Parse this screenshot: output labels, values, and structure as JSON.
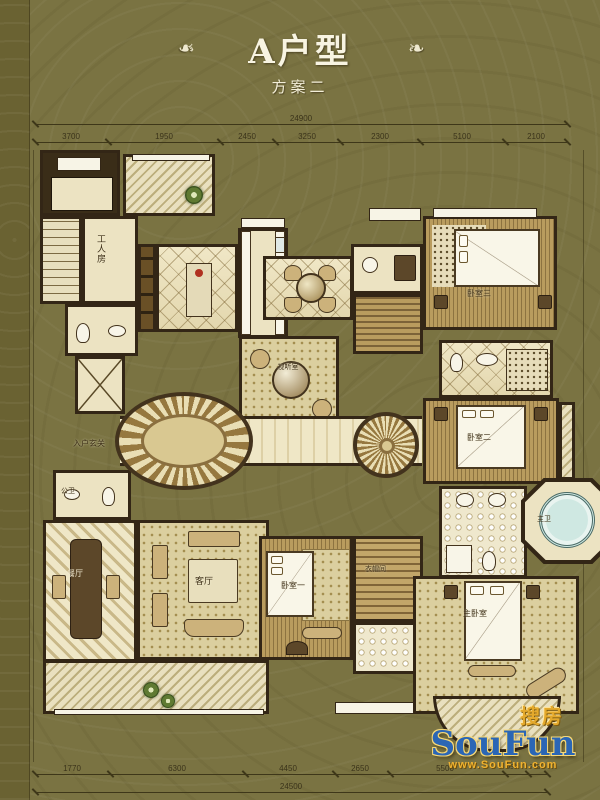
{
  "header": {
    "title": "A户型",
    "subtitle": "方案二",
    "flourish_left": "❧",
    "flourish_right": "❧"
  },
  "dimensions": {
    "top": {
      "overall": "24900",
      "segments": [
        "3700",
        "1950",
        "2450",
        "3250",
        "2300",
        "5100",
        "2100"
      ]
    },
    "bottom": {
      "overall": "24500",
      "segments": [
        "1770",
        "6300",
        "4450",
        "2650",
        "5500",
        "950",
        "745"
      ]
    }
  },
  "rooms": {
    "worker_room": "工人房",
    "foyer": "入户玄关",
    "public_bath": "公卫",
    "dining": "餐厅",
    "living": "客厅",
    "av_room": "视听室",
    "bedroom1": "卧室一",
    "bedroom2": "卧室二",
    "bedroom3": "卧室三",
    "master_bedroom": "主卧室",
    "master_bath": "主卫",
    "cloakroom": "衣帽间"
  },
  "watermark": {
    "cn": "搜房",
    "en": "SouFun",
    "url": "www.SouFun.com"
  },
  "colors": {
    "background": "#7a7342",
    "wall": "#332616",
    "accent_gold": "#e4a92c",
    "logo_blue": "#2b66b5"
  }
}
